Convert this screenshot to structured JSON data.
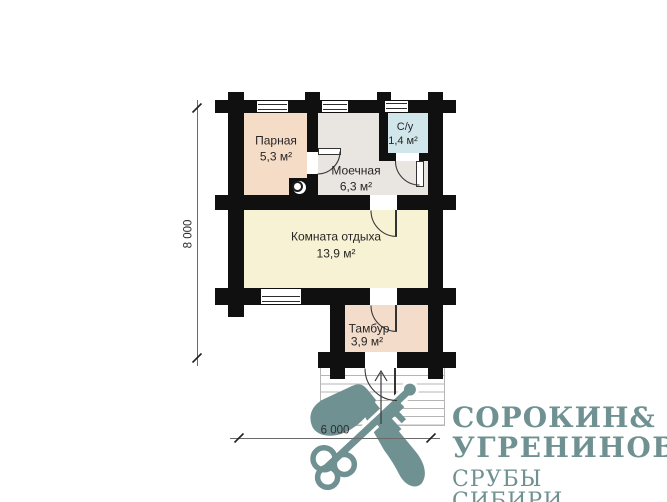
{
  "floor_plan": {
    "rooms": [
      {
        "name": "Парная",
        "area": "5,3 м²"
      },
      {
        "name": "Моечная",
        "area": "6,3 м²"
      },
      {
        "name": "С/у",
        "area": "1,4 м²"
      },
      {
        "name": "Комната отдыха",
        "area": "13,9 м²"
      },
      {
        "name": "Тамбур",
        "area": "3,9 м²"
      }
    ],
    "dimensions": {
      "vertical": "8 000",
      "horizontal": "6 000"
    },
    "colors": {
      "wall": "#101010",
      "parnaya_fill": "#f5dcc6",
      "moechnaya_fill": "#e9e6e1",
      "su_fill": "#d0e6ea",
      "komnata_fill": "#f7f2d4",
      "tambur_fill": "#f4dccb",
      "steps_line": "#b5b5b5"
    }
  },
  "logo": {
    "brand_word_1": "СОРОКИН",
    "brand_ampersand": "&",
    "brand_word_2": "УГРЕНИНОВ",
    "tagline": "СРУБЫ СИБИРИ",
    "color": "#6f9192",
    "icon": "crossed-axe-and-key"
  }
}
